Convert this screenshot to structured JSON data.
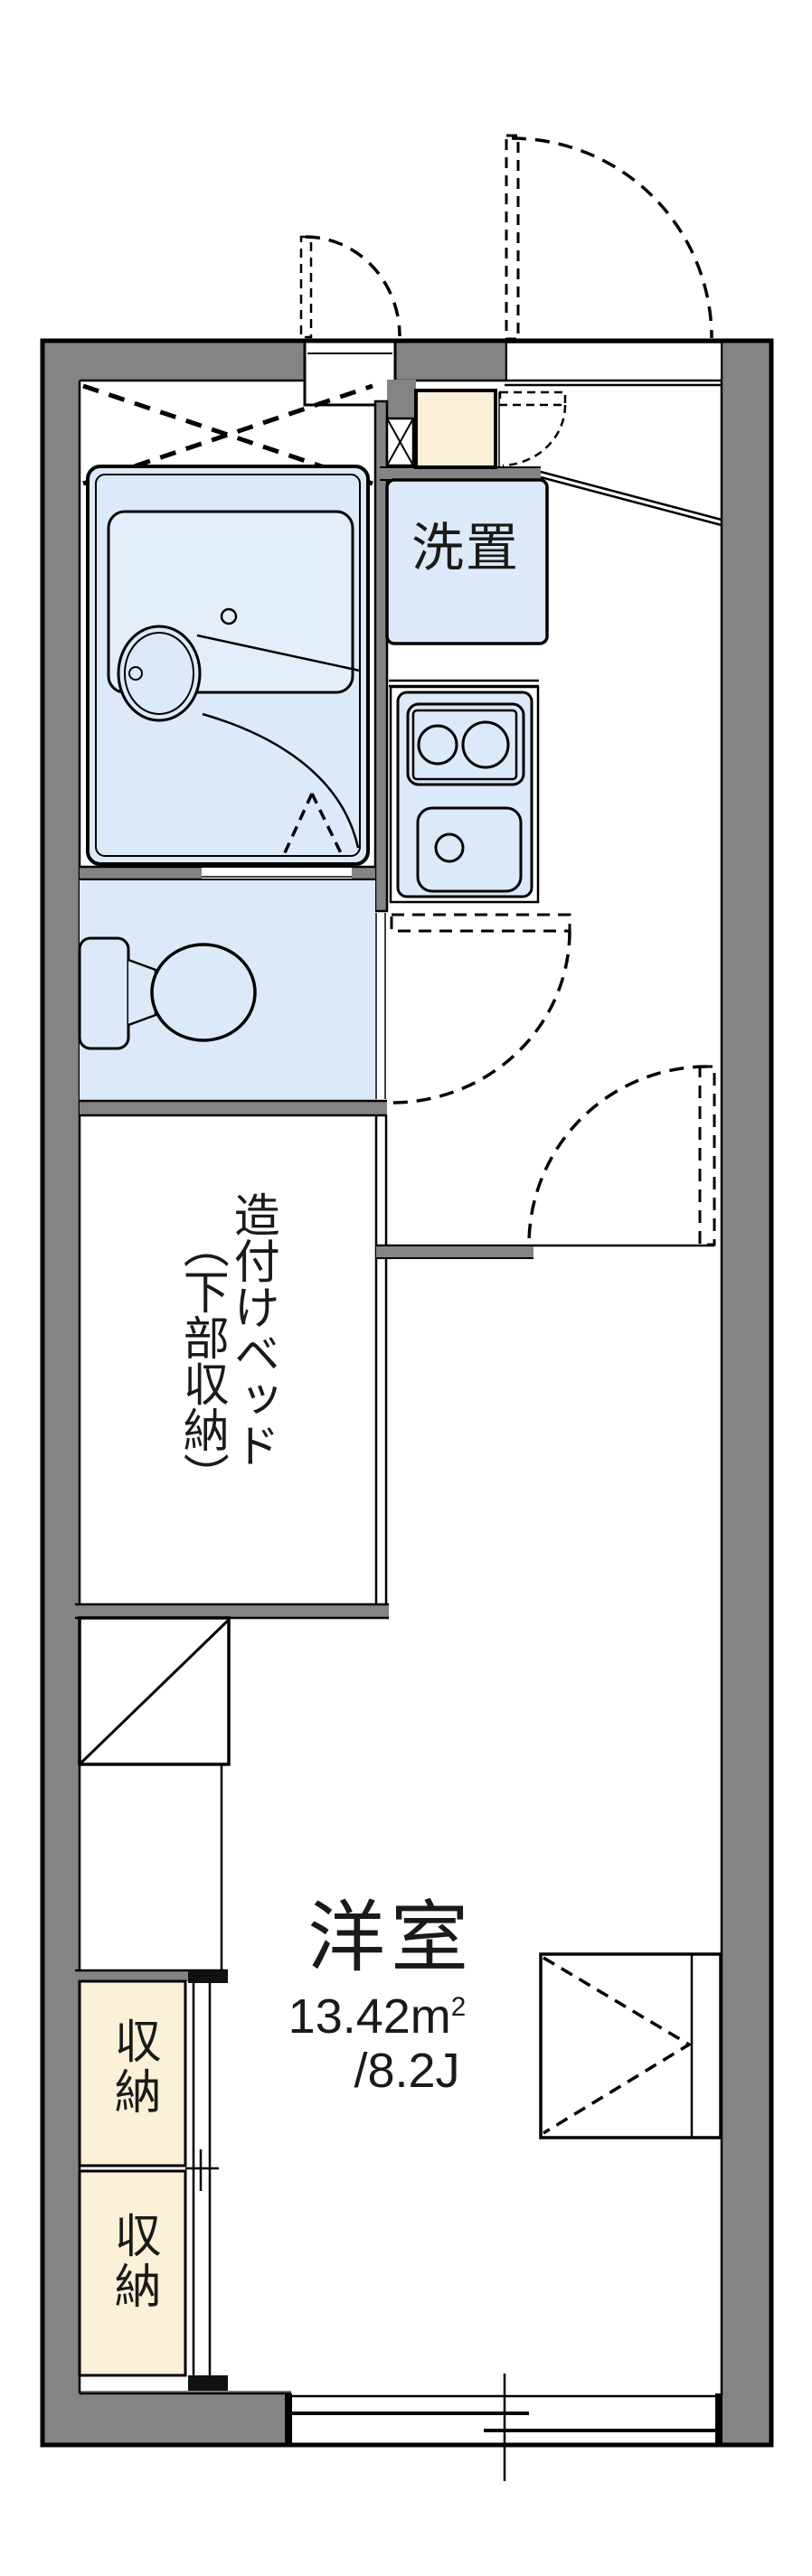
{
  "plan_type": "apartment-floor-plan",
  "colors": {
    "wall_gray": "#848484",
    "fixture_blue": "#dce9f8",
    "fixture_blue_light": "#e4eefa",
    "closet_cream": "#fcf0d8",
    "line_black": "#000000",
    "text": "#1a1a1a",
    "background": "#ffffff"
  },
  "labels": {
    "washer_space": "洗置",
    "built_in_bed_line1": "造付けベッド",
    "built_in_bed_line2": "（下部収納）",
    "main_room_name": "洋室",
    "main_room_area_base": "13.42m",
    "main_room_area_exponent": "2",
    "main_room_area_tatami": "/8.2J",
    "storage_upper": "収納",
    "storage_lower": "収納"
  },
  "rooms": [
    {
      "name": "洋室",
      "area_sqm": "13.42㎡",
      "area_tatami": "8.2J"
    },
    {
      "name": "造付けベッド（下部収納）"
    },
    {
      "name": "洗置"
    },
    {
      "name": "収納"
    },
    {
      "name": "収納"
    }
  ]
}
